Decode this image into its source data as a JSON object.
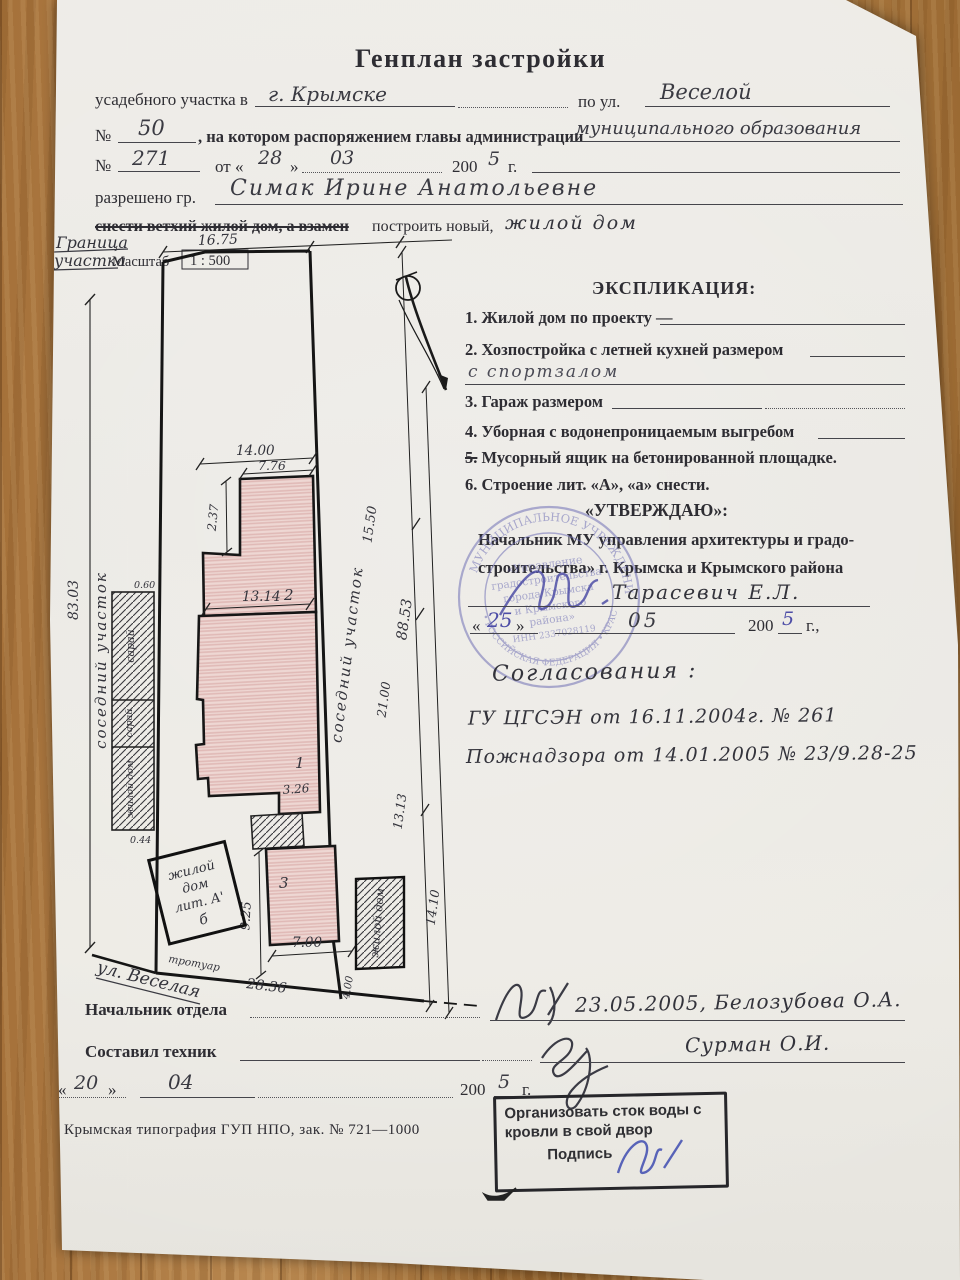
{
  "page": {
    "title": "Генплан застройки"
  },
  "form": {
    "line1_pre": "усадебного участка в",
    "line1_value": "г. Крымске",
    "line1_mid": "по ул.",
    "line1_value2": "Веселой",
    "no_label": "№",
    "line2_no": "50",
    "line2_text": ", на котором распоряжением главы администрации",
    "line2_value": "муниципального образования",
    "line3_no": "271",
    "line3_ot": "от «",
    "line3_day": "28",
    "line3_close": "»",
    "line3_month": "03",
    "line3_year_pre": "200",
    "line3_year": "5",
    "line3_g": "г.",
    "line4_label": "разрешено гр.",
    "line4_value": "Симак Ирине Анатольевне",
    "line5_struck": "снести ветхий жилой дом, а взамен",
    "line5_rest": "построить новый,",
    "line5_hand": "жилой дом"
  },
  "plan": {
    "border_label1": "Граница",
    "border_label2": "участка",
    "scale_label": "Масштаб",
    "scale_value": "1 : 500",
    "street": "ул. Веселая",
    "sidewalk": "тротуар",
    "labels": {
      "sosed_left": "соседний  участок",
      "sosed_mid": "соседний  участок",
      "saray1": "сарай",
      "saray2": "сарай",
      "zhiloy_left": "жилой дом",
      "b1": "1",
      "b2": "2",
      "b3": "3",
      "lit1": "жилой",
      "lit2": "дом",
      "lit3": "лит. А'",
      "lit4": "б",
      "zhiloy_right": "жилой дом"
    },
    "dims": {
      "top": "16.75",
      "left": "83.03",
      "w14": "14.00",
      "w776": "7.76",
      "h237": "2.37",
      "d1550": "15.50",
      "w1314": "13.14",
      "d2100": "21.00",
      "right": "88.53",
      "d1313": "13.13",
      "w326": "3.26",
      "h925": "9.25",
      "w700": "7.00",
      "bottom": "28.36",
      "d1410": "14.10",
      "w400": "4.00",
      "s060": "0.60",
      "s044": "0.44"
    }
  },
  "explication": {
    "title": "ЭКСПЛИКАЦИЯ:",
    "items": [
      {
        "num": "1.",
        "text": "Жилой дом по проекту —"
      },
      {
        "num": "2.",
        "text": "Хозпостройка с летней кухней размером"
      },
      {
        "num": "3.",
        "text": "Гараж размером"
      },
      {
        "num": "4.",
        "text": "Уборная с водонепроницаемым выгребом"
      },
      {
        "num": "5.",
        "text": "Мусорный ящик на бетонированной площадке."
      },
      {
        "num": "6.",
        "text": "Строение лит. «А», «а» снести."
      }
    ],
    "item2_hand": "с спортзалом"
  },
  "approve": {
    "title": "«УТВЕРЖДАЮ»:",
    "line1": "Начальник МУ управления архитектуры и градо-",
    "line2": "строительства» г. Крымска и Крымского района",
    "name": "Тарасевич Е.Л.",
    "q_open": "«",
    "date_day": "25",
    "q_close": "»",
    "date_month": "05",
    "year_pre": "200",
    "date_year": "5",
    "g": "г.,"
  },
  "stamp": {
    "outer_top": "МУНИЦИПАЛЬНОЕ УЧРЕЖДЕНИЕ",
    "outer_bottom": "• РОССИЙСКАЯ ФЕДЕРАЦИЯ • КРАСНОДАРСКИЙ КРАЙ",
    "inner1": "«Управление",
    "inner2": "градостроительства",
    "inner3": "города Крымска",
    "inner4": "и Крымского",
    "inner5": "района»",
    "inner6": "ИНН 2337028119",
    "color": "#6f6fb4"
  },
  "agreements": {
    "title": "Согласования :",
    "line1": "ГУ ЦГСЭН  от 16.11.2004г.   № 261",
    "line2": "Пожнадзора  от 14.01.2005  № 23/9.28-25"
  },
  "officials": {
    "head_label": "Начальник отдела",
    "head_value": "23.05.2005,   Белозубова О.А.",
    "tech_label": "Составил техник",
    "tech_value": "Сурман О.И.",
    "q_open": "«",
    "date_day": "20",
    "q_close": "»",
    "date_month": "04",
    "year_pre": "200",
    "date_year": "5",
    "g": "г."
  },
  "footer": {
    "print_info": "Крымская типография ГУП НПО, зак. №  721—1000"
  },
  "note_stamp": {
    "line1": "Организовать сток воды с",
    "line2": "кровли в свой двор",
    "sign_label": "Подпись"
  }
}
